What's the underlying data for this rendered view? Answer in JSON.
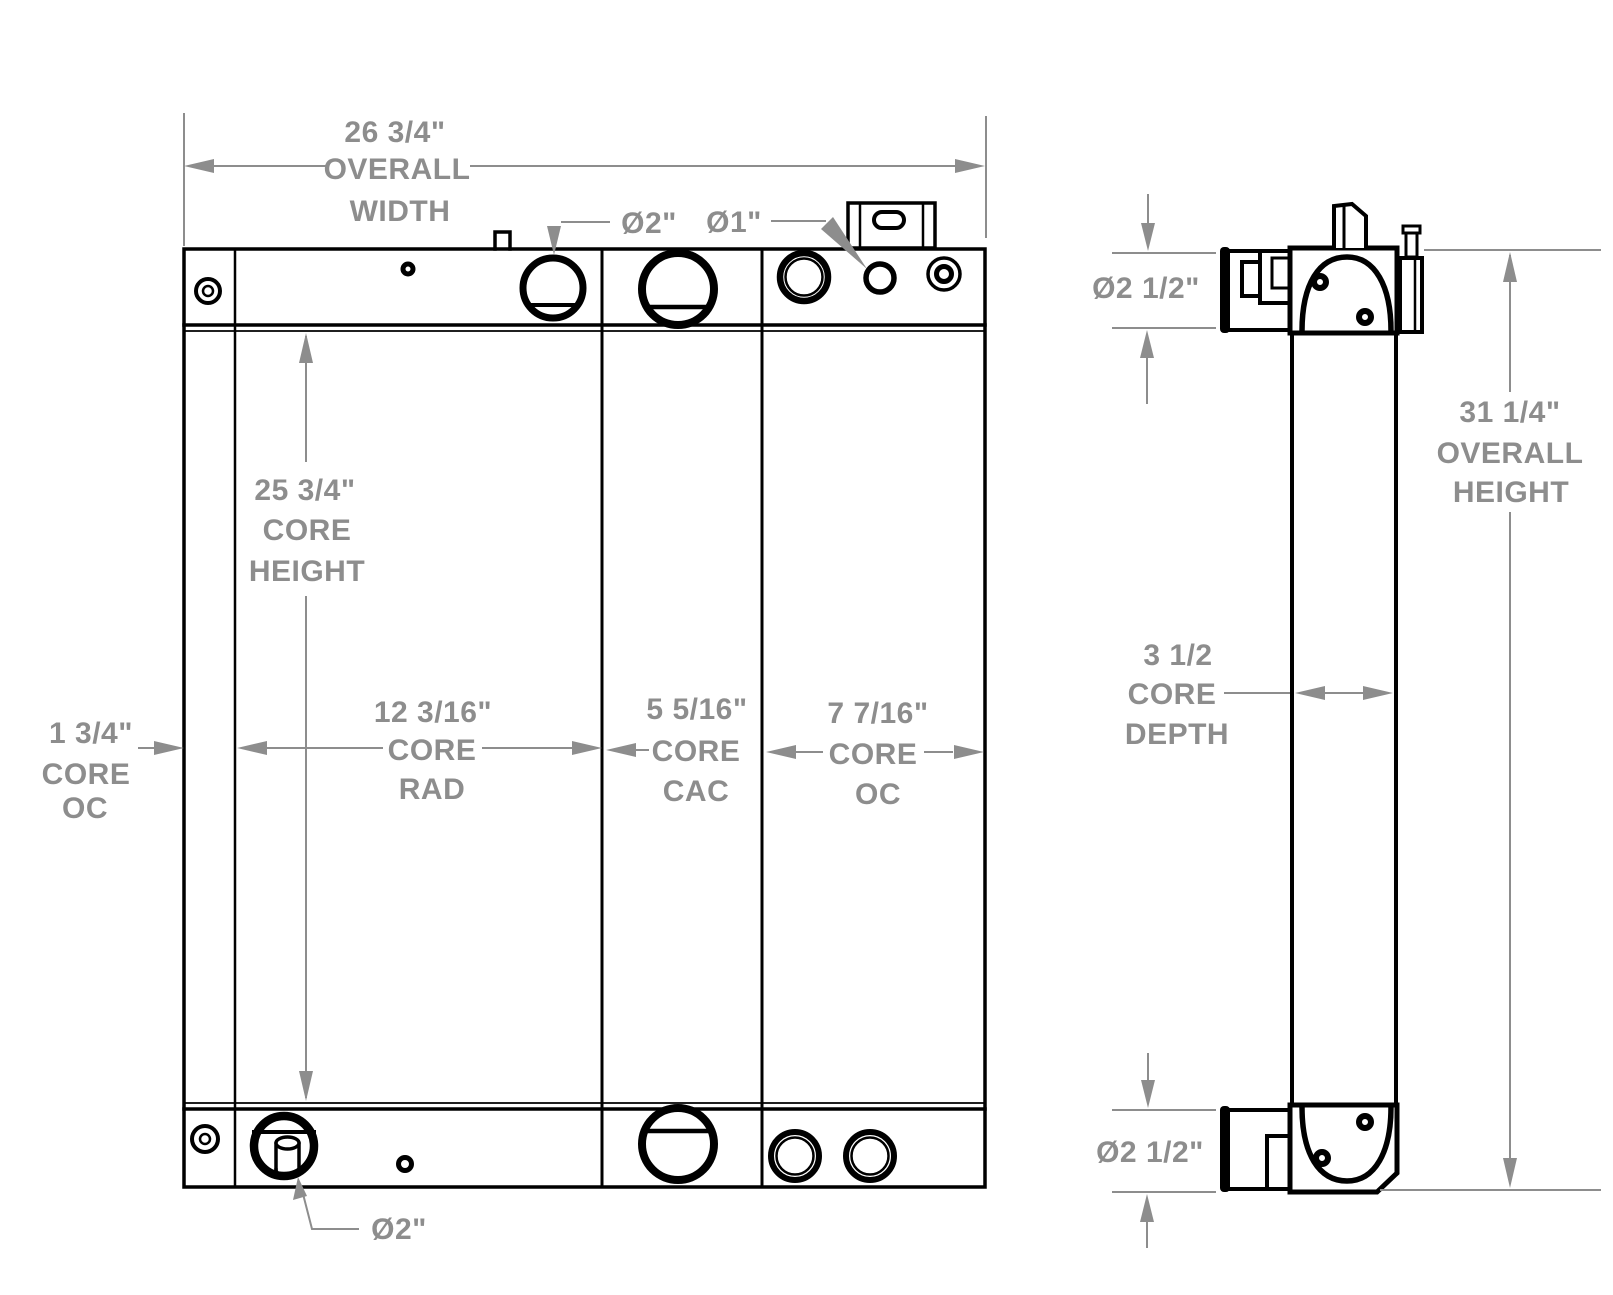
{
  "colors": {
    "line": "#000000",
    "dimension": "#8d8d8d",
    "background": "#ffffff"
  },
  "front_view": {
    "overall_width": [
      "26 3/4\"",
      "OVERALL",
      "WIDTH"
    ],
    "core_height": [
      "25 3/4\"",
      "CORE",
      "HEIGHT"
    ],
    "core_oc_left": [
      "1 3/4\"",
      "CORE",
      "OC"
    ],
    "core_rad": [
      "12 3/16\"",
      "CORE",
      "RAD"
    ],
    "core_cac": [
      "5 5/16\"",
      "CORE",
      "CAC"
    ],
    "core_oc_right": [
      "7 7/16\"",
      "CORE",
      "OC"
    ],
    "top_rad_port_dia": "Ø2\"",
    "top_oc_port_dia": "Ø1\"",
    "bottom_rad_port_dia": "Ø2\""
  },
  "side_view": {
    "top_port_dia": "Ø2 1/2\"",
    "overall_height": [
      "31 1/4\"",
      "OVERALL",
      "HEIGHT"
    ],
    "core_depth": [
      "3 1/2",
      "CORE",
      "DEPTH"
    ],
    "bottom_port_dia": "Ø2 1/2\""
  }
}
